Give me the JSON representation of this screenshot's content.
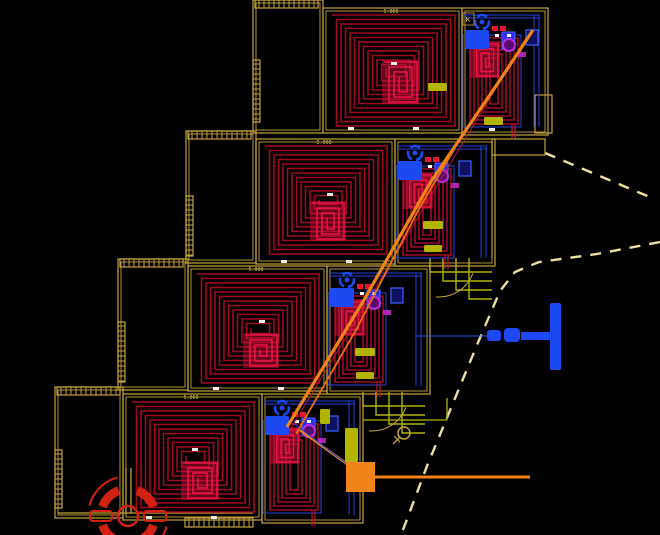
{
  "app": {
    "view_title": "underfloor-heating-plan"
  },
  "canvas": {
    "width": 660,
    "height": 535,
    "background": "#000000"
  },
  "colors": {
    "wall": "#c6a23c",
    "wall_bright": "#e2cd72",
    "coil": "#a20720",
    "coil_mid": "#c00b2e",
    "coil_bright": "#ef1448",
    "core_fill": "#d90f3e",
    "manifold_blue": "#1d49f2",
    "pipe_blue": "#2443e0",
    "purple": "#b62ee0",
    "magenta": "#cc28cc",
    "supply_orange": "#f08418",
    "olive": "#b2b400",
    "boundary": "#ece09e",
    "tick_white": "#ffffff",
    "symbol_red": "#d32114",
    "text_yellow": "#e0ca48",
    "pipe_red": "#d01530"
  },
  "units": [
    {
      "id": "unit-1",
      "garage": {
        "x": 253,
        "y": 0,
        "w": 70,
        "h": 133
      },
      "garage_hatch_top": {
        "x": 255,
        "y": 0,
        "w": 63,
        "h": 8
      },
      "garage_hatch_left": {
        "x": 253,
        "y": 60,
        "w": 7,
        "h": 62
      },
      "main": {
        "x": 323,
        "y": 8,
        "w": 139,
        "h": 125
      },
      "manifold": {
        "x": 462,
        "y": 8,
        "w": 86,
        "h": 127
      },
      "spiral": {
        "x": 332,
        "y": 15,
        "w": 123,
        "h": 111
      },
      "core": {
        "x": 382,
        "y": 60,
        "w": 37,
        "h": 44
      },
      "dim_label": {
        "text": "5.000",
        "x": 391,
        "y": 13
      },
      "room_label": {
        "text": "K",
        "x": 467,
        "y": 22
      },
      "olive_boxes": [
        [
          428,
          83,
          19,
          8
        ],
        [
          484,
          117,
          19,
          8
        ]
      ],
      "ticks": [
        [
          348,
          127
        ],
        [
          413,
          127
        ],
        [
          489,
          128
        ],
        [
          391,
          62
        ]
      ]
    },
    {
      "id": "unit-2",
      "garage": {
        "x": 186,
        "y": 131,
        "w": 70,
        "h": 132
      },
      "garage_hatch_top": {
        "x": 188,
        "y": 131,
        "w": 63,
        "h": 8
      },
      "garage_hatch_left": {
        "x": 186,
        "y": 196,
        "w": 7,
        "h": 60
      },
      "main": {
        "x": 256,
        "y": 139,
        "w": 139,
        "h": 125
      },
      "manifold": {
        "x": 395,
        "y": 139,
        "w": 100,
        "h": 127
      },
      "spiral": {
        "x": 265,
        "y": 146,
        "w": 122,
        "h": 108
      },
      "core": {
        "x": 310,
        "y": 201,
        "w": 36,
        "h": 40
      },
      "dim_label": {
        "text": "5.000",
        "x": 324,
        "y": 144
      },
      "olive_boxes": [
        [
          423,
          221,
          20,
          8
        ],
        [
          424,
          245,
          18,
          7
        ]
      ],
      "ticks": [
        [
          281,
          260
        ],
        [
          346,
          260
        ],
        [
          327,
          193
        ]
      ]
    },
    {
      "id": "unit-3",
      "garage": {
        "x": 118,
        "y": 259,
        "w": 70,
        "h": 131
      },
      "garage_hatch_top": {
        "x": 120,
        "y": 259,
        "w": 63,
        "h": 8
      },
      "garage_hatch_left": {
        "x": 118,
        "y": 322,
        "w": 7,
        "h": 60
      },
      "main": {
        "x": 188,
        "y": 266,
        "w": 139,
        "h": 125
      },
      "manifold": {
        "x": 327,
        "y": 266,
        "w": 103,
        "h": 128
      },
      "spiral": {
        "x": 197,
        "y": 274,
        "w": 122,
        "h": 109
      },
      "core": {
        "x": 243,
        "y": 333,
        "w": 36,
        "h": 35
      },
      "dim_label": {
        "text": "5.000",
        "x": 256,
        "y": 271
      },
      "olive_boxes": [
        [
          355,
          348,
          20,
          8
        ],
        [
          356,
          372,
          18,
          7
        ]
      ],
      "ticks": [
        [
          213,
          387
        ],
        [
          278,
          387
        ],
        [
          259,
          320
        ]
      ]
    },
    {
      "id": "unit-4",
      "garage": {
        "x": 55,
        "y": 387,
        "w": 68,
        "h": 131
      },
      "garage_hatch_top": {
        "x": 57,
        "y": 387,
        "w": 63,
        "h": 8
      },
      "garage_hatch_left": {
        "x": 55,
        "y": 450,
        "w": 7,
        "h": 58
      },
      "main": {
        "x": 123,
        "y": 394,
        "w": 139,
        "h": 126
      },
      "manifold": {
        "x": 262,
        "y": 394,
        "w": 101,
        "h": 129
      },
      "main_hatch_bottom": {
        "x": 185,
        "y": 518,
        "w": 68,
        "h": 9
      },
      "spiral": {
        "x": 132,
        "y": 402,
        "w": 122,
        "h": 110
      },
      "core": {
        "x": 181,
        "y": 461,
        "w": 38,
        "h": 39
      },
      "dim_label": {
        "text": "5.000",
        "x": 191,
        "y": 399
      },
      "olive_boxes": [
        [
          320,
          409,
          10,
          15
        ],
        [
          345,
          428,
          13,
          34
        ]
      ],
      "ticks": [
        [
          146,
          516
        ],
        [
          211,
          516
        ],
        [
          192,
          448
        ]
      ]
    }
  ],
  "terraces": {
    "unit1_step_rect": [
      535,
      95,
      17,
      38
    ],
    "unit2_wall_v": [
      492,
      141,
      492,
      258
    ],
    "unit2_step_rect": [
      492,
      139,
      53,
      16
    ],
    "unit3_steps_origin": [
      430,
      258
    ],
    "unit3_arc": {
      "cx": 439,
      "cy": 261,
      "r": 36
    },
    "unit4_steps_origin": [
      363,
      392
    ],
    "unit4_arc": {
      "cx": 372,
      "cy": 395,
      "r": 36
    },
    "unit4_extra_lines": [
      [
        363,
        420,
        447,
        420
      ],
      [
        447,
        398,
        447,
        420
      ]
    ]
  },
  "supply": {
    "main_diagonal": [
      [
        287,
        427
      ],
      [
        364,
        300
      ],
      [
        430,
        183
      ],
      [
        500,
        80
      ],
      [
        533,
        30
      ]
    ],
    "second_diagonal": [
      [
        296,
        434
      ],
      [
        356,
        330
      ],
      [
        420,
        207
      ],
      [
        455,
        148
      ]
    ],
    "connector": [
      [
        358,
        472
      ],
      [
        300,
        430
      ]
    ],
    "horizontal_line": [
      [
        365,
        477
      ],
      [
        530,
        477
      ]
    ],
    "junction_box": {
      "x": 346,
      "y": 462,
      "w": 29,
      "h": 30
    },
    "red_pair": [
      [
        290,
        430
      ],
      [
        526,
        38
      ]
    ],
    "blue_stub": [
      [
        293,
        423
      ],
      [
        352,
        468
      ]
    ]
  },
  "hydrant": {
    "bar": [
      550,
      303,
      11,
      67
    ],
    "stem": [
      521,
      332,
      30,
      8
    ],
    "valve1": [
      504,
      328,
      16,
      14
    ],
    "valve2": [
      487,
      330,
      14,
      11
    ],
    "service_line": [
      415,
      336,
      487,
      336
    ]
  },
  "boundary": {
    "path1": [
      [
        545,
        153
      ],
      [
        652,
        198
      ]
    ],
    "path2": [
      [
        660,
        242
      ],
      [
        597,
        254
      ],
      [
        539,
        262
      ],
      [
        515,
        272
      ],
      [
        500,
        291
      ],
      [
        477,
        345
      ],
      [
        451,
        408
      ],
      [
        427,
        466
      ],
      [
        406,
        522
      ],
      [
        401,
        535
      ]
    ]
  },
  "manhole_symbol": {
    "cx": 128,
    "cy": 516,
    "r_inner": 10,
    "r_ring": 27,
    "ring_width": 9,
    "arc_segments": [
      [
        20,
        70
      ],
      [
        110,
        160
      ],
      [
        200,
        250
      ],
      [
        290,
        340
      ]
    ],
    "outer_arcs": [
      [
        15,
        75
      ],
      [
        195,
        255
      ]
    ],
    "outer_r": 40,
    "side_rects": [
      [
        90,
        511,
        22,
        10
      ],
      [
        144,
        511,
        22,
        10
      ]
    ]
  },
  "survey_circle": {
    "cx": 404,
    "cy": 433,
    "r": 6
  },
  "driveway_lines": [
    [
      58,
      513,
      253,
      513
    ],
    [
      126,
      468,
      126,
      513
    ],
    [
      131,
      468,
      131,
      513
    ]
  ]
}
